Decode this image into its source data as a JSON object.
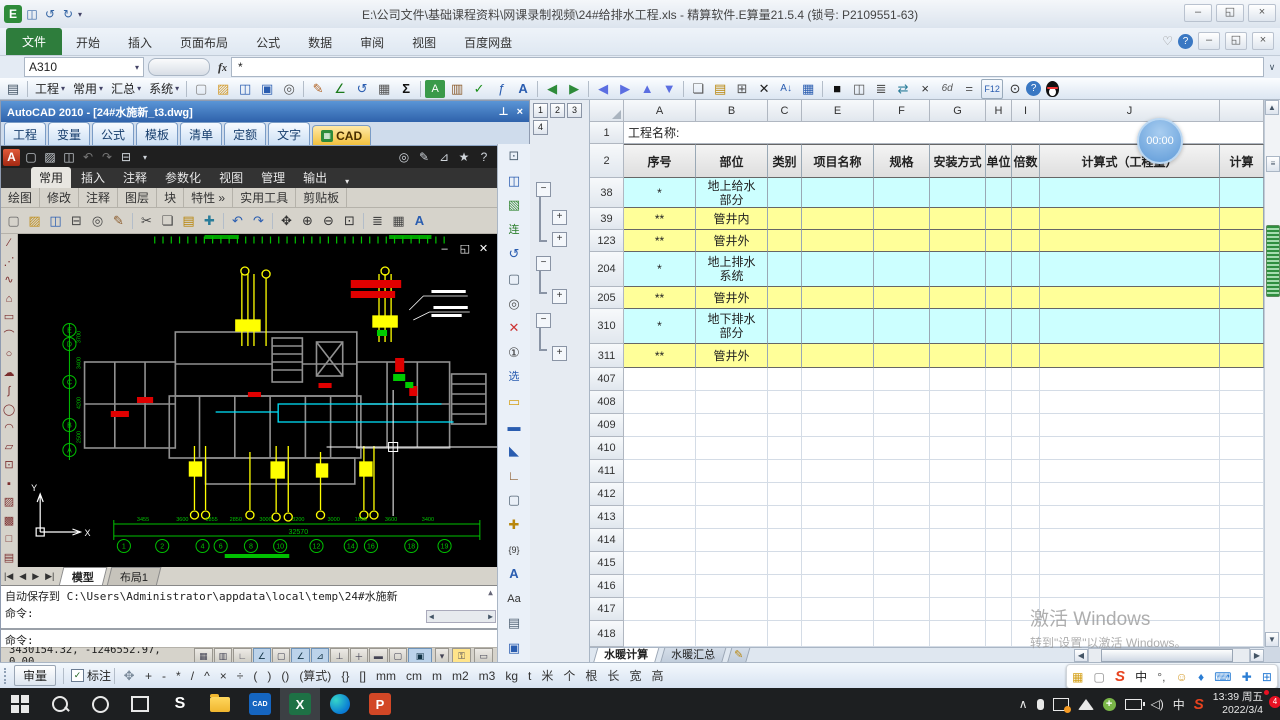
{
  "window": {
    "title": "E:\\公司文件\\基础课程资料\\网课录制视频\\24#给排水工程.xls - 精算软件.E算量21.5.4 (锁号: P2109551-63)"
  },
  "ribbon": {
    "tabs": [
      "文件",
      "开始",
      "插入",
      "页面布局",
      "公式",
      "数据",
      "审阅",
      "视图",
      "百度网盘"
    ]
  },
  "formula_bar": {
    "name_box": "A310",
    "fx": "fx",
    "value": "*"
  },
  "toolbar": {
    "menus": [
      "工程",
      "常用",
      "汇总",
      "系统"
    ]
  },
  "cad": {
    "title": "AutoCAD 2010 - [24#水施新_t3.dwg]",
    "etabs": [
      "工程",
      "变量",
      "公式",
      "模板",
      "清单",
      "定额",
      "文字",
      "CAD"
    ],
    "ribbon_tabs": [
      "常用",
      "插入",
      "注释",
      "参数化",
      "视图",
      "管理",
      "输出"
    ],
    "panels": [
      "绘图",
      "修改",
      "注释",
      "图层",
      "块",
      "特性",
      "实用工具",
      "剪贴板"
    ],
    "layout_tabs": [
      "模型",
      "布局1"
    ],
    "command_lines": [
      "自动保存到 C:\\Users\\Administrator\\appdata\\local\\temp\\24#水施新",
      "命令:",
      "命令:"
    ],
    "status_coords": "3430154.32, -1246552.97, 0.00",
    "drawing": {
      "axis_letters": [
        "E",
        "D",
        "C",
        "B",
        "A"
      ],
      "axis_numbers": [
        "1",
        "2",
        "4",
        "6",
        "8",
        "10",
        "12",
        "14",
        "16",
        "18",
        "19"
      ],
      "bottom_dims": [
        "3455",
        "3600",
        "1855",
        "2850",
        "3000",
        "3200",
        "3000",
        "1855",
        "3600",
        "3400"
      ],
      "left_dims": [
        "3700",
        "3400",
        "4200",
        "2500"
      ],
      "total_dim": "32570"
    }
  },
  "spreadsheet": {
    "outline_levels": [
      "1",
      "2",
      "3",
      "4"
    ],
    "columns": [
      {
        "letter": "A",
        "title": "序号"
      },
      {
        "letter": "B",
        "title": "部位"
      },
      {
        "letter": "C",
        "title": "类别"
      },
      {
        "letter": "E",
        "title": "项目名称"
      },
      {
        "letter": "F",
        "title": "规格"
      },
      {
        "letter": "G",
        "title": "安装方式"
      },
      {
        "letter": "H",
        "title": "单位"
      },
      {
        "letter": "I",
        "title": "倍数"
      },
      {
        "letter": "J",
        "title": "计算式（工程量）"
      },
      {
        "letter": "",
        "title": "计算"
      }
    ],
    "row1_num": "1",
    "row2_num": "2",
    "row1_label": "工程名称:",
    "rows": [
      {
        "num": "38",
        "seq": "*",
        "part": "地上给水部分",
        "color": "cyan"
      },
      {
        "num": "39",
        "seq": "**",
        "part": "管井内",
        "color": "yellow"
      },
      {
        "num": "123",
        "seq": "**",
        "part": "管井外",
        "color": "yellow"
      },
      {
        "num": "204",
        "seq": "*",
        "part": "地上排水系统",
        "color": "cyan"
      },
      {
        "num": "205",
        "seq": "**",
        "part": "管井外",
        "color": "yellow"
      },
      {
        "num": "310",
        "seq": "*",
        "part": "地下排水部分",
        "color": "cyan"
      },
      {
        "num": "311",
        "seq": "**",
        "part": "管井外",
        "color": "yellow"
      }
    ],
    "empty_rows": [
      "407",
      "408",
      "409",
      "410",
      "411",
      "412",
      "413",
      "414",
      "415",
      "416",
      "417",
      "418"
    ],
    "sheet_tabs": [
      "水暖计算",
      "水暖汇总"
    ],
    "timer": "00:00"
  },
  "unit_bar": {
    "review": "审量",
    "annotate": "标注",
    "buttons": [
      "+",
      "-",
      "*",
      "/",
      "^",
      "×",
      "÷",
      "(",
      ")",
      "()",
      "(算式)",
      "{}",
      "[]",
      "mm",
      "cm",
      "m",
      "m2",
      "m3",
      "kg",
      "t",
      "米",
      "个",
      "根",
      "长",
      "宽",
      "高"
    ]
  },
  "watermark": {
    "line1": "激活 Windows",
    "line2": "转到\"设置\"以激活 Windows。"
  },
  "taskbar": {
    "cad_label": "CAD",
    "excel_label": "X",
    "ppt_label": "P",
    "ime_label": "中",
    "time1": "13:39 周五",
    "time2": "2022/3/4",
    "badge": "4"
  }
}
